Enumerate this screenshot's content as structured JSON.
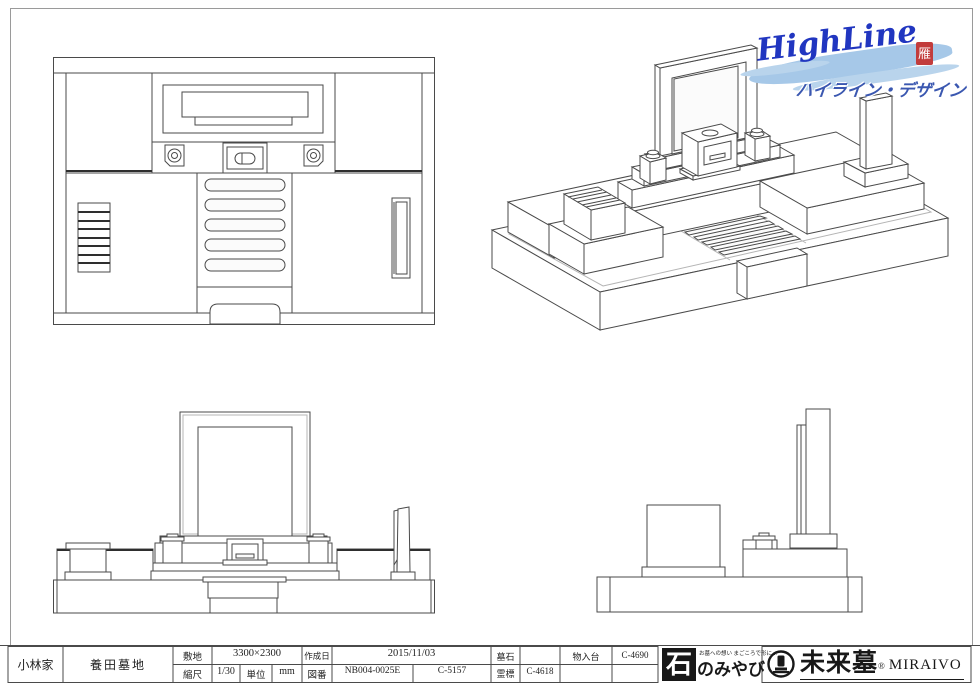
{
  "colors": {
    "line": "#4a4a4a",
    "logo_blue": "#2136c0",
    "brush_blue": "#a6c8e8",
    "katakana_blue": "#3a57b0",
    "seal_red": "#c23c3c",
    "ink_black": "#181818"
  },
  "highline_logo": {
    "script": "HighLine",
    "katakana": "ハイライン・デザイン",
    "seal": "雁"
  },
  "title_block": {
    "family": "小林家",
    "cemetery": "養田墓地",
    "site_label": "敷地",
    "site_value": "3300×2300",
    "date_label": "作成日",
    "date_value": "2015/11/03",
    "scale_label": "縮尺",
    "scale_value": "1/30",
    "unit_label": "単位",
    "unit_value": "mm",
    "zuban_label": "図番",
    "zuban_value1": "NB004-0025E",
    "zuban_value2": "C-5157",
    "boseki_label": "墓石",
    "boseki_value": "",
    "reihyo_label": "霊標",
    "reihyo_value": "C-4618",
    "monoire_label": "物入台",
    "monoire_value": "C-4690"
  },
  "ishimiyabi_logo": {
    "tagline": "お墓への想い まごころで形に…",
    "ishi": "石",
    "suffix": "のみやび"
  },
  "miraibo_logo": {
    "kanji": "未来墓",
    "reg": "®",
    "roman": "MIRAIVO"
  }
}
